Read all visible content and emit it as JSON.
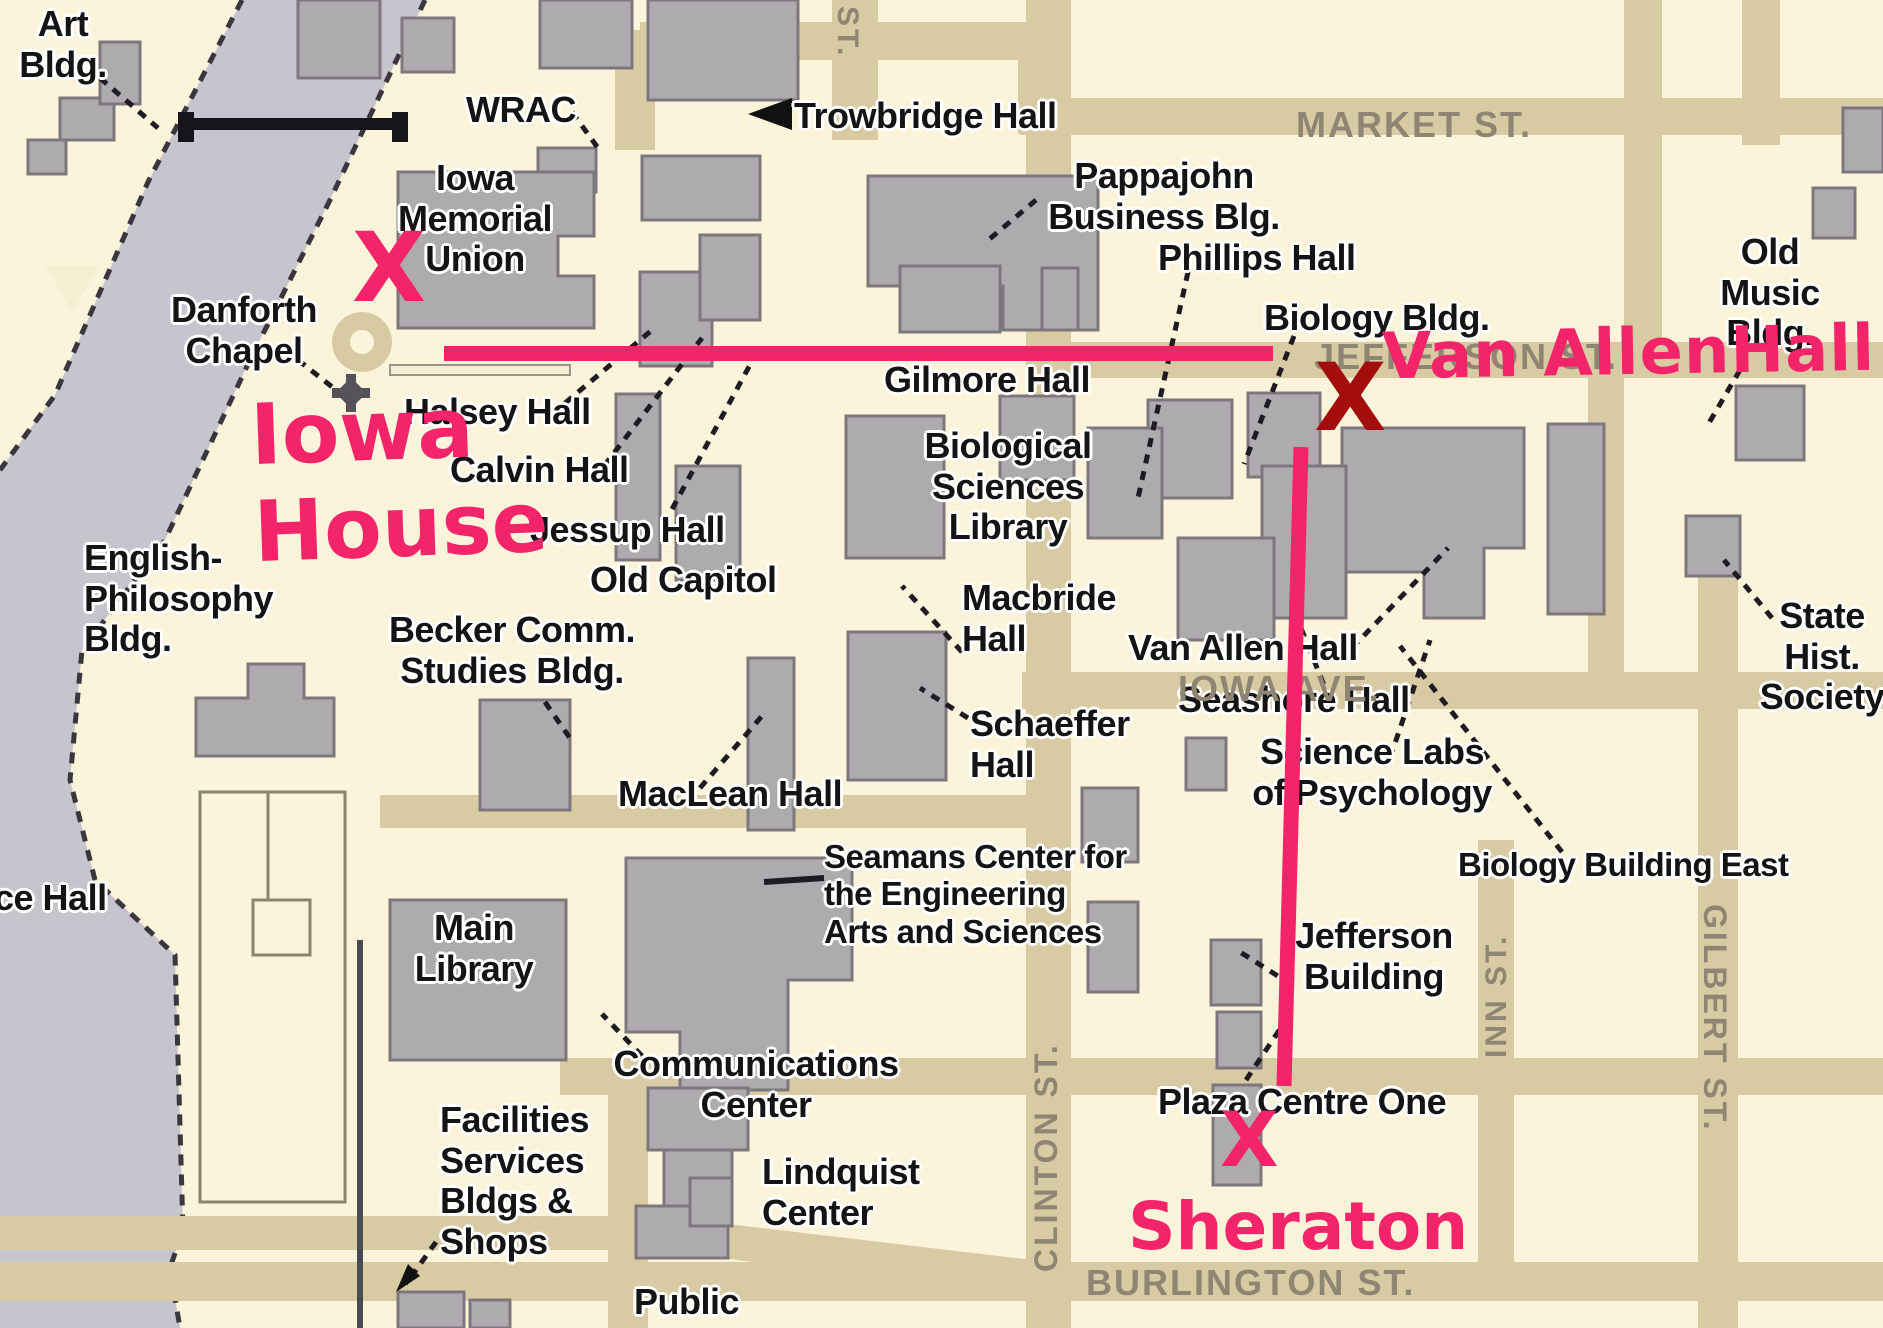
{
  "colors": {
    "background": "#FBF4DA",
    "street": "#D8CBA4",
    "building_fill": "#AEABAE",
    "building_outline": "#7C777C",
    "river": "#C6C4CC",
    "black_label": "#141414",
    "street_label": "#8E8672",
    "route_pink": "#F4246B",
    "dark_red_x": "#A40D0D"
  },
  "street_labels": {
    "market": "MARKET ST.",
    "jefferson": "JEFFERSON ST.",
    "iowa_ave": "IOWA AVE.",
    "burlington": "BURLINGTON ST.",
    "clinton": "CLINTON ST.",
    "inn": "INN ST.",
    "gilbert": "GILBERT ST.",
    "st_partial": "ST."
  },
  "building_labels": {
    "art": [
      "Art",
      "Bldg."
    ],
    "wrac": [
      "WRAC"
    ],
    "trowbridge": [
      "Trowbridge Hall"
    ],
    "imu": [
      "Iowa",
      "Memorial",
      "Union"
    ],
    "pappajohn": [
      "Pappajohn",
      "Business Blg."
    ],
    "phillips": [
      "Phillips Hall"
    ],
    "biology_bldg": [
      "Biology Bldg."
    ],
    "old_music": [
      "Old",
      "Music",
      "Bldg."
    ],
    "danforth": [
      "Danforth",
      "Chapel"
    ],
    "halsey": [
      "Halsey Hall"
    ],
    "calvin": [
      "Calvin Hall"
    ],
    "jessup": [
      "Jessup Hall"
    ],
    "old_capitol": [
      "Old Capitol"
    ],
    "english_philosophy": [
      "English-",
      "Philosophy",
      "Bldg."
    ],
    "becker": [
      "Becker Comm.",
      "Studies Bldg."
    ],
    "gilmore": [
      "Gilmore Hall"
    ],
    "bio_sci_library": [
      "Biological",
      "Sciences",
      "Library"
    ],
    "macbride": [
      "Macbride",
      "Hall"
    ],
    "van_allen_hall": [
      "Van Allen Hall"
    ],
    "seashore": [
      "Seashore Hall"
    ],
    "science_labs": [
      "Science Labs",
      "of Psychology"
    ],
    "biology_building_east": [
      "Biology Building East"
    ],
    "state_hist": [
      "State",
      "Hist.",
      "Society"
    ],
    "maclean": [
      "MacLean Hall"
    ],
    "schaeffer": [
      "Schaeffer",
      "Hall"
    ],
    "seamans": [
      "Seamans Center for",
      "the Engineering",
      "Arts and Sciences"
    ],
    "main_library": [
      "Main",
      "Library"
    ],
    "jefferson_building": [
      "Jefferson",
      "Building"
    ],
    "communications": [
      "Communications",
      "Center"
    ],
    "facilities": [
      "Facilities",
      "Services",
      "Bldgs &",
      "Shops"
    ],
    "lindquist": [
      "Lindquist",
      "Center"
    ],
    "plaza_centre": [
      "Plaza Centre One"
    ],
    "public": [
      "Public"
    ],
    "ce_hall": [
      "ce Hall"
    ]
  },
  "annotations": {
    "x_mark": "X",
    "iowa_house": [
      "Iowa",
      "House"
    ],
    "van_allen_note": "Van AllenHall",
    "sheraton": "Sheraton"
  }
}
